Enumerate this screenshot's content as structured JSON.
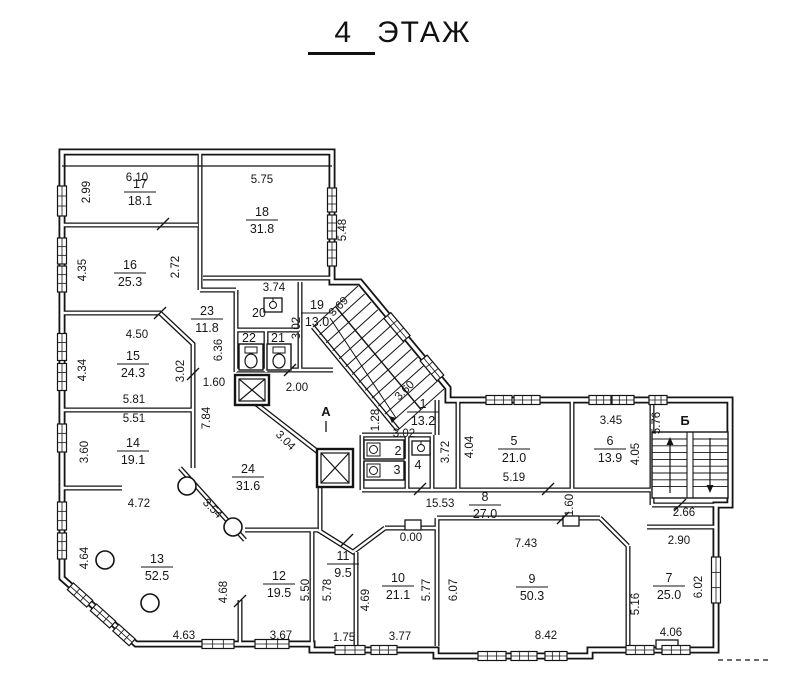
{
  "title": {
    "number": "4",
    "word": "ЭТАЖ"
  },
  "plan": {
    "rooms": [
      {
        "num": "17",
        "area": "18.1",
        "x": 140,
        "y": 188
      },
      {
        "num": "16",
        "area": "25.3",
        "x": 130,
        "y": 269
      },
      {
        "num": "18",
        "area": "31.8",
        "x": 262,
        "y": 216
      },
      {
        "num": "23",
        "area": "11.8",
        "x": 207,
        "y": 315
      },
      {
        "num": "19",
        "area": "13.0",
        "x": 317,
        "y": 309
      },
      {
        "num": "15",
        "area": "24.3",
        "x": 133,
        "y": 360
      },
      {
        "num": "14",
        "area": "19.1",
        "x": 133,
        "y": 447
      },
      {
        "num": "24",
        "area": "31.6",
        "x": 248,
        "y": 473
      },
      {
        "num": "13",
        "area": "52.5",
        "x": 157,
        "y": 563
      },
      {
        "num": "12",
        "area": "19.5",
        "x": 279,
        "y": 580
      },
      {
        "num": "11",
        "area": "9.5",
        "x": 343,
        "y": 560
      },
      {
        "num": "10",
        "area": "21.1",
        "x": 398,
        "y": 582
      },
      {
        "num": "9",
        "area": "50.3",
        "x": 532,
        "y": 583
      },
      {
        "num": "8",
        "area": "27.0",
        "x": 485,
        "y": 501
      },
      {
        "num": "7",
        "area": "25.0",
        "x": 669,
        "y": 582
      },
      {
        "num": "6",
        "area": "13.9",
        "x": 610,
        "y": 445
      },
      {
        "num": "5",
        "area": "21.0",
        "x": 514,
        "y": 445
      },
      {
        "num": "1",
        "area": "13.2",
        "x": 423,
        "y": 408
      }
    ],
    "single_rooms": [
      {
        "num": "20",
        "x": 259,
        "y": 317
      },
      {
        "num": "22",
        "x": 249,
        "y": 342
      },
      {
        "num": "21",
        "x": 278,
        "y": 342
      },
      {
        "num": "2",
        "x": 398,
        "y": 455
      },
      {
        "num": "3",
        "x": 397,
        "y": 474
      },
      {
        "num": "4",
        "x": 418,
        "y": 469
      }
    ],
    "dims": [
      {
        "t": "6.10",
        "x": 137,
        "y": 181,
        "r": 0
      },
      {
        "t": "2.99",
        "x": 90,
        "y": 192,
        "r": 90
      },
      {
        "t": "5.75",
        "x": 262,
        "y": 183,
        "r": 0
      },
      {
        "t": "5.48",
        "x": 346,
        "y": 230,
        "r": 90
      },
      {
        "t": "4.35",
        "x": 86,
        "y": 270,
        "r": 90
      },
      {
        "t": "2.72",
        "x": 179,
        "y": 267,
        "r": 90
      },
      {
        "t": "3.74",
        "x": 274,
        "y": 291,
        "r": 0
      },
      {
        "t": "3.02",
        "x": 300,
        "y": 328,
        "r": 90
      },
      {
        "t": "3.69",
        "x": 341,
        "y": 309,
        "r": -45
      },
      {
        "t": "6.36",
        "x": 222,
        "y": 350,
        "r": 90
      },
      {
        "t": "4.50",
        "x": 137,
        "y": 338,
        "r": 0
      },
      {
        "t": "4.34",
        "x": 86,
        "y": 370,
        "r": 90
      },
      {
        "t": "3.02",
        "x": 184,
        "y": 371,
        "r": 90
      },
      {
        "t": "5.81",
        "x": 134,
        "y": 403,
        "r": 0
      },
      {
        "t": "1.60",
        "x": 214,
        "y": 386,
        "r": 0
      },
      {
        "t": "2.00",
        "x": 297,
        "y": 391,
        "r": 0
      },
      {
        "t": "7.84",
        "x": 210,
        "y": 418,
        "r": 90
      },
      {
        "t": "3.04",
        "x": 283,
        "y": 443,
        "r": 45
      },
      {
        "t": "5.51",
        "x": 134,
        "y": 422,
        "r": 0
      },
      {
        "t": "3.60",
        "x": 88,
        "y": 452,
        "r": 90
      },
      {
        "t": "4.72",
        "x": 139,
        "y": 507,
        "r": 0
      },
      {
        "t": "3.54",
        "x": 210,
        "y": 511,
        "r": 45
      },
      {
        "t": "4.64",
        "x": 88,
        "y": 558,
        "r": 90
      },
      {
        "t": "4.63",
        "x": 184,
        "y": 639,
        "r": 0
      },
      {
        "t": "4.68",
        "x": 227,
        "y": 592,
        "r": 90
      },
      {
        "t": "5.50",
        "x": 309,
        "y": 590,
        "r": 90
      },
      {
        "t": "3.67",
        "x": 281,
        "y": 639,
        "r": 0
      },
      {
        "t": "5.78",
        "x": 331,
        "y": 590,
        "r": 90
      },
      {
        "t": "1.75",
        "x": 344,
        "y": 641,
        "r": 0
      },
      {
        "t": "4.69",
        "x": 369,
        "y": 600,
        "r": 90
      },
      {
        "t": "3.77",
        "x": 400,
        "y": 640,
        "r": 0
      },
      {
        "t": "5.77",
        "x": 430,
        "y": 590,
        "r": 90
      },
      {
        "t": "6.07",
        "x": 457,
        "y": 590,
        "r": 90
      },
      {
        "t": "15.53",
        "x": 440,
        "y": 507,
        "r": 0
      },
      {
        "t": "1.28",
        "x": 379,
        "y": 420,
        "r": 90
      },
      {
        "t": "3.02",
        "x": 404,
        "y": 437,
        "r": 0
      },
      {
        "t": "3.60",
        "x": 407,
        "y": 393,
        "r": -45
      },
      {
        "t": "3.72",
        "x": 449,
        "y": 452,
        "r": 90
      },
      {
        "t": "4.04",
        "x": 473,
        "y": 447,
        "r": 90
      },
      {
        "t": "5.19",
        "x": 514,
        "y": 481,
        "r": 0
      },
      {
        "t": "1.60",
        "x": 573,
        "y": 505,
        "r": 90
      },
      {
        "t": "3.45",
        "x": 611,
        "y": 424,
        "r": 0
      },
      {
        "t": "4.05",
        "x": 639,
        "y": 454,
        "r": 90
      },
      {
        "t": "5.76",
        "x": 660,
        "y": 423,
        "r": 90
      },
      {
        "t": "2.66",
        "x": 684,
        "y": 516,
        "r": 0
      },
      {
        "t": "2.90",
        "x": 679,
        "y": 544,
        "r": 0
      },
      {
        "t": "6.02",
        "x": 702,
        "y": 587,
        "r": 90
      },
      {
        "t": "4.06",
        "x": 671,
        "y": 636,
        "r": 0
      },
      {
        "t": "5.16",
        "x": 639,
        "y": 604,
        "r": 90
      },
      {
        "t": "7.43",
        "x": 526,
        "y": 547,
        "r": 0
      },
      {
        "t": "8.42",
        "x": 546,
        "y": 639,
        "r": 0
      },
      {
        "t": "0.00",
        "x": 411,
        "y": 541,
        "r": 0
      }
    ],
    "marks": [
      {
        "t": "А",
        "x": 326,
        "y": 416
      },
      {
        "t": "Б",
        "x": 685,
        "y": 425
      }
    ]
  }
}
